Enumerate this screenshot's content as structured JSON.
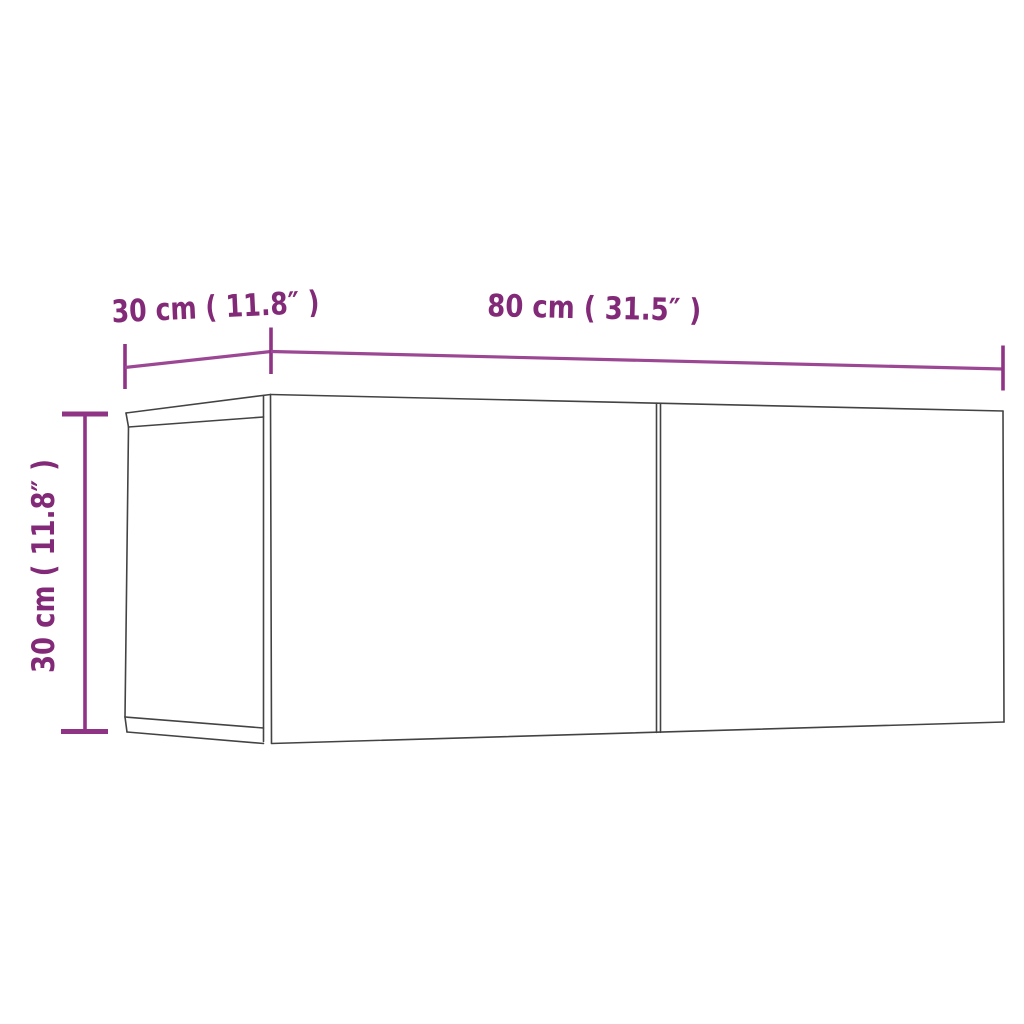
{
  "diagram": {
    "title": "TV wall cabinet dimension drawing",
    "colors": {
      "background": "#ffffff",
      "cabinet_outline": "#434343",
      "dimension_line": "#9c4794",
      "dimension_text": "#822a78"
    },
    "dimensions": [
      {
        "name": "depth",
        "cm": 30,
        "inches": 11.8,
        "label": "30 cm ( 11.8″ )"
      },
      {
        "name": "width",
        "cm": 80,
        "inches": 31.5,
        "label": "80 cm ( 31.5″ )"
      },
      {
        "name": "height",
        "cm": 30,
        "inches": 11.8,
        "label": "30 cm ( 11.8″ )"
      }
    ]
  }
}
